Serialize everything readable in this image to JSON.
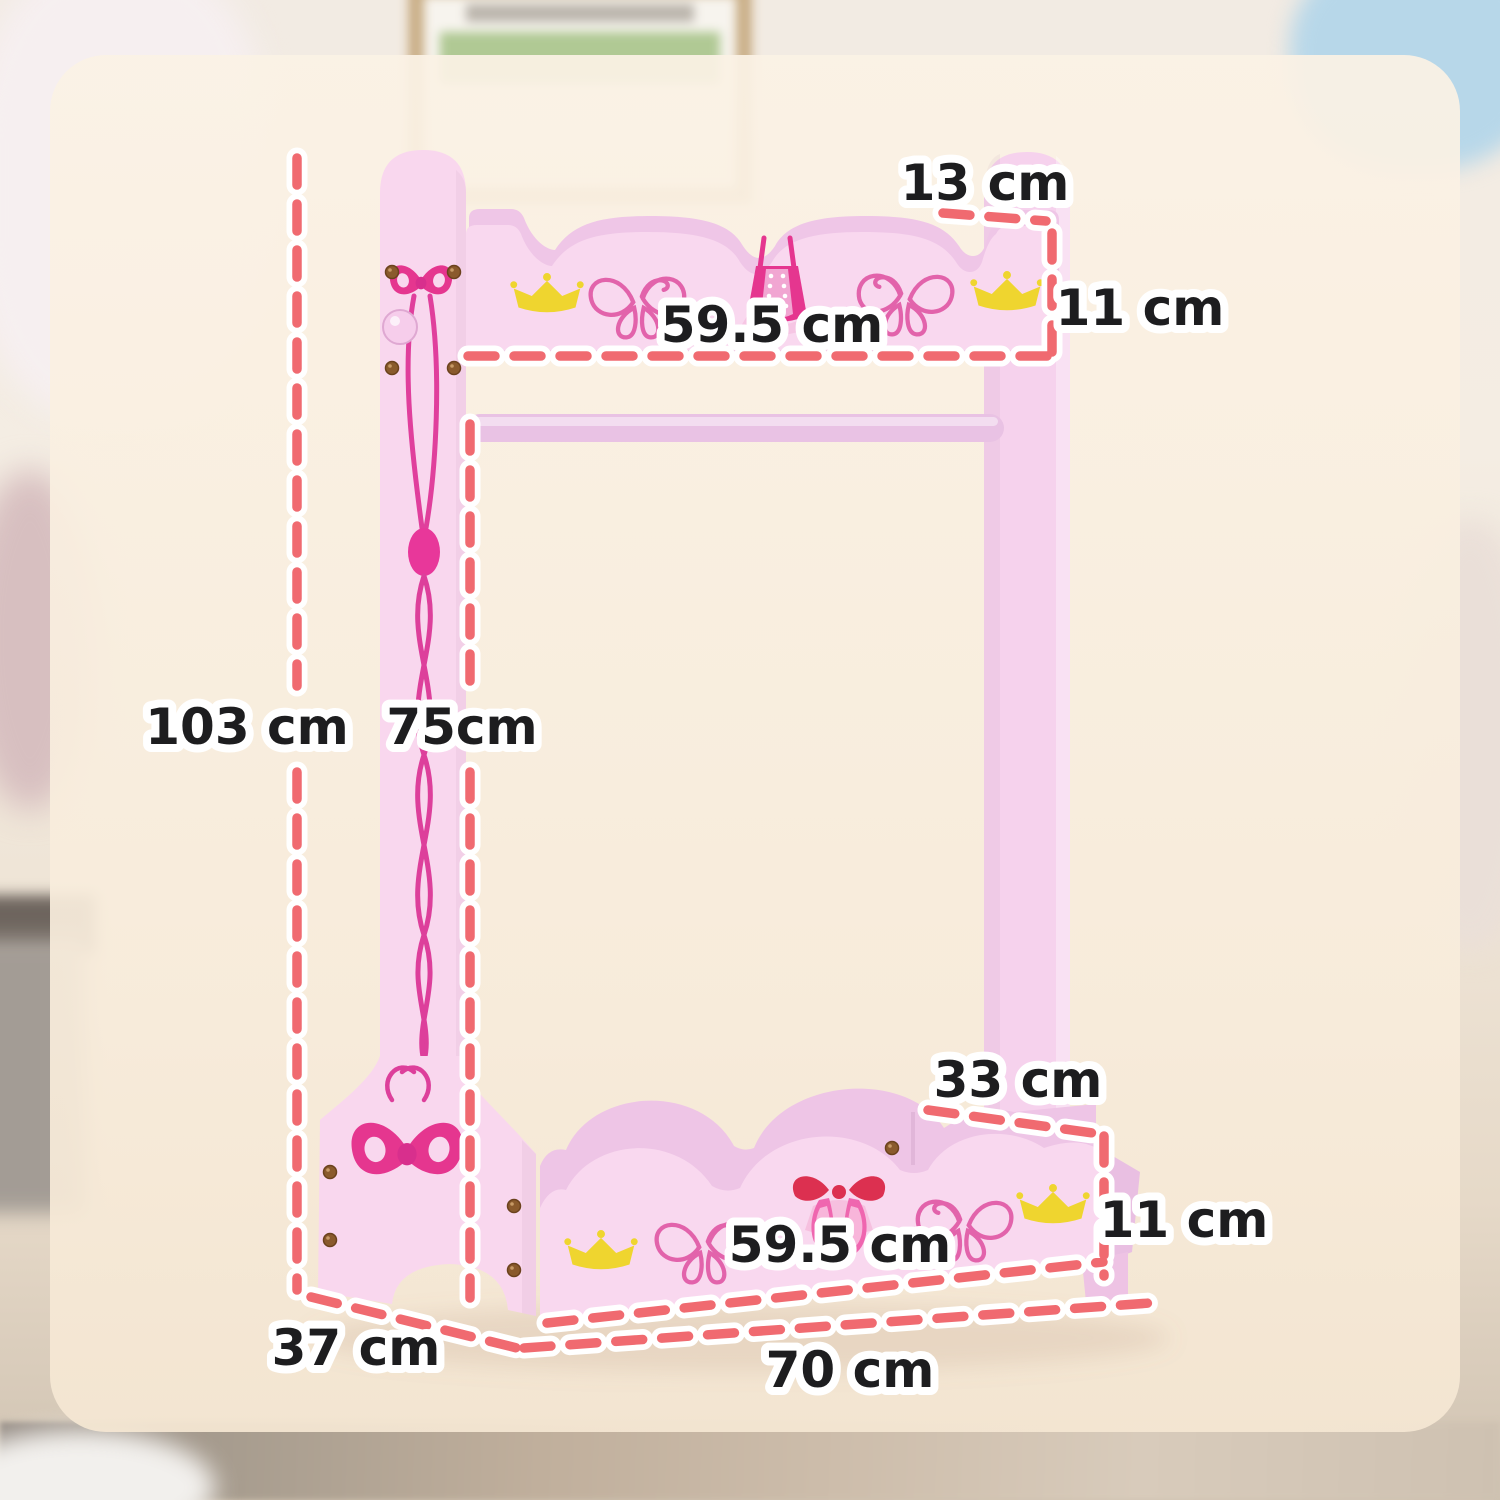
{
  "diagram": {
    "labels": {
      "top_depth": "13 cm",
      "top_shelf_height": "11 cm",
      "top_shelf_width": "59.5 cm",
      "overall_height": "103 cm",
      "hanging_height": "75cm",
      "tray_depth": "33 cm",
      "tray_height": "11 cm",
      "tray_width": "59.5 cm",
      "base_depth": "37 cm",
      "overall_width": "70 cm"
    },
    "colors": {
      "dash_red": "#f06a70",
      "panel_pink": "#f9d7ee",
      "shadow_pink": "#efc6e7",
      "motif_magenta": "#e5368f",
      "crown_yellow": "#efd52f",
      "butterfly_pink": "#e263ab",
      "overlay_cream": "#f9efe0",
      "label_text": "#1d1d1f",
      "label_outline": "#ffffff"
    },
    "motifs": [
      "bow-icon",
      "crown-icon",
      "butterfly-icon",
      "corset-icon",
      "ballet-slippers-icon"
    ]
  }
}
